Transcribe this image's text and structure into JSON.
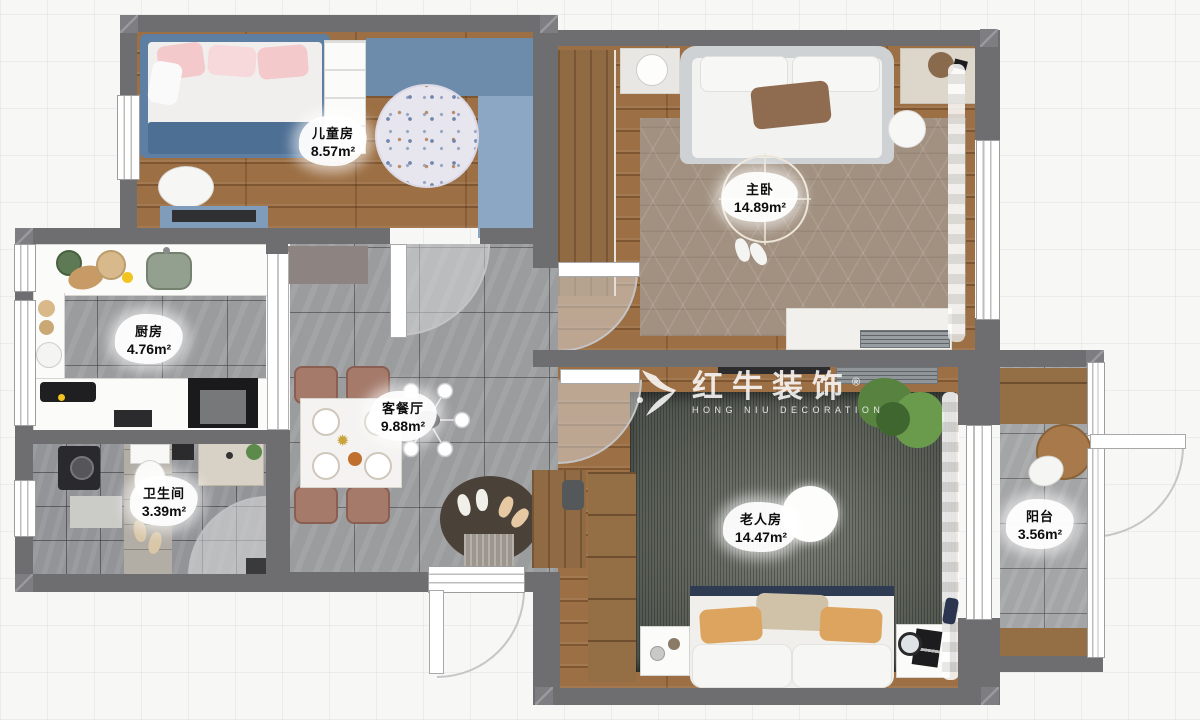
{
  "watermark": {
    "brand": "红牛装饰",
    "registered": "®",
    "brand_sub": "HONG NIU DECORATION"
  },
  "rooms": [
    {
      "name": "儿童房",
      "area": "8.57m²"
    },
    {
      "name": "主卧",
      "area": "14.89m²"
    },
    {
      "name": "厨房",
      "area": "4.76m²"
    },
    {
      "name": "客餐厅",
      "area": "9.88m²"
    },
    {
      "name": "卫生间",
      "area": "3.39m²"
    },
    {
      "name": "老人房",
      "area": "14.47m²"
    },
    {
      "name": "阳台",
      "area": "3.56m²"
    }
  ],
  "colors": {
    "wall": "#6e6e71",
    "wood_floor": "#9c6f44",
    "gray_tile": "#9b9c9e",
    "accent_blue": "#7f9cba",
    "master_rug": "#a29180",
    "elder_rug": "#5d635c",
    "background": "#f7f7f6"
  }
}
